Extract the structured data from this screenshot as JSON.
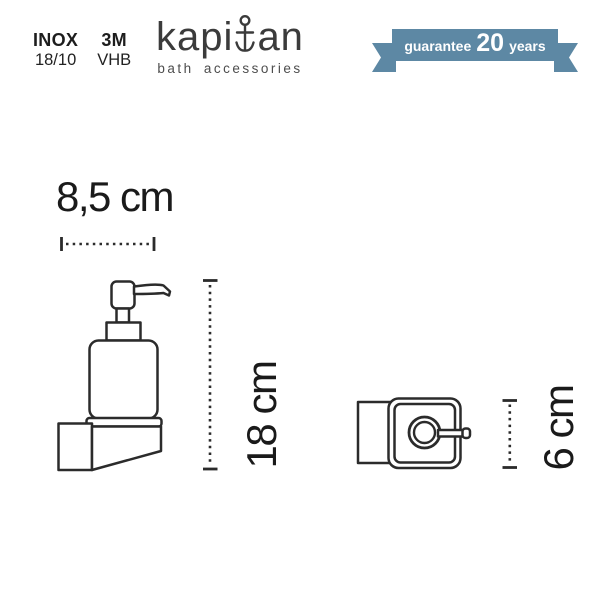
{
  "header": {
    "material_specs": [
      {
        "title": "INOX",
        "subtitle": "18/10"
      },
      {
        "title": "3M",
        "subtitle": "VHB"
      }
    ],
    "logo": {
      "name_part1": "kapi",
      "name_part2": "an",
      "subtitle": "bath accessories"
    },
    "guarantee_ribbon": {
      "label": "guarantee",
      "years_value": "20",
      "years_label": "years",
      "color": "#5d88a4"
    }
  },
  "diagram": {
    "front_view": {
      "width_dimension": "8,5 cm",
      "height_dimension": "18 cm"
    },
    "top_view": {
      "depth_dimension": "6 cm"
    }
  }
}
